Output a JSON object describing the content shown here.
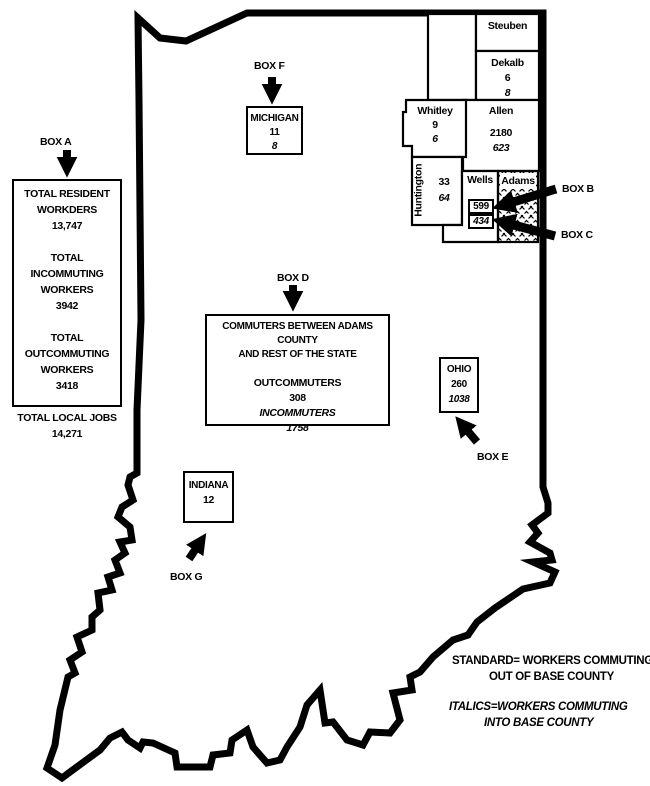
{
  "colors": {
    "ink": "#000000",
    "paper": "#ffffff"
  },
  "box_a": {
    "label": "BOX A",
    "rows": [
      "TOTAL RESIDENT",
      "WORKDERS",
      "13,747",
      "",
      "TOTAL INCOMMUTING",
      "WORKERS",
      "3942",
      "",
      "TOTAL OUTCOMMUTING",
      "WORKERS",
      "3418",
      "",
      "TOTAL LOCAL JOBS",
      "14,271"
    ]
  },
  "box_b": {
    "label": "BOX B"
  },
  "box_c": {
    "label": "BOX C"
  },
  "box_d": {
    "label": "BOX D",
    "title_line1": "COMMUTERS BETWEEN ADAMS COUNTY",
    "title_line2": "AND REST OF THE STATE",
    "outcommuters_label": "OUTCOMMUTERS",
    "outcommuters_value": "308",
    "incommuters_label": "INCOMMUTERS",
    "incommuters_value": "1758"
  },
  "box_e": {
    "label": "BOX E"
  },
  "box_f": {
    "label": "BOX F"
  },
  "box_g": {
    "label": "BOX G"
  },
  "external_areas": {
    "michigan": {
      "name": "MICHIGAN",
      "out": "11",
      "in": "8"
    },
    "ohio": {
      "name": "OHIO",
      "out": "260",
      "in": "1038"
    },
    "indiana": {
      "name": "INDIANA",
      "out": "12"
    }
  },
  "counties": {
    "steuben": {
      "name": "Steuben"
    },
    "dekalb": {
      "name": "Dekalb",
      "out": "6",
      "in": "8"
    },
    "allen": {
      "name": "Allen",
      "out": "2180",
      "in": "623"
    },
    "whitley": {
      "name": "Whitley",
      "out": "9",
      "in": "6"
    },
    "huntington": {
      "name": "Huntington",
      "out": "33",
      "in": "64"
    },
    "wells": {
      "name": "Wells",
      "out": "599",
      "in": "434"
    },
    "adams": {
      "name": "Adams"
    }
  },
  "legend": {
    "standard_line1": "STANDARD= WORKERS COMMUTING",
    "standard_line2": "OUT OF BASE COUNTY",
    "italics_line1": "ITALICS=WORKERS COMMUTING",
    "italics_line2": "INTO BASE COUNTY"
  }
}
